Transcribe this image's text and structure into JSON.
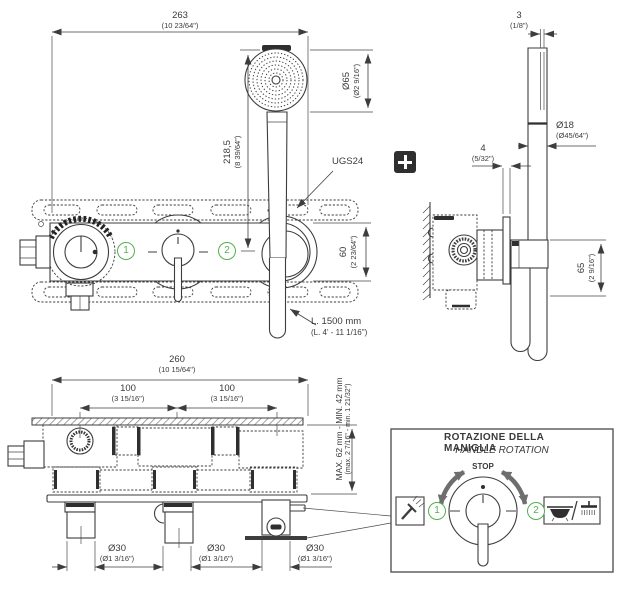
{
  "colors": {
    "line": "#3d3d3d",
    "green": "#53b14e",
    "gray": "#6e6e6e",
    "dark": "#2f2f2f"
  },
  "icons": {
    "badge": "plus-icon",
    "position1": "handshower-icon",
    "position2": "bathtub-overhead-shower-icon"
  },
  "front_view": {
    "width_mm": "263",
    "width_in": "(10 23/64\")",
    "height_mm": "218,5",
    "height_in": "(8 39/64\")",
    "head_mm": "Ø65",
    "head_in": "(Ø2 9/16\")",
    "offset_mm": "60",
    "offset_in": "(2 23/64\")",
    "bracket_code": "UGS24",
    "hose_mm": "L. 1500 mm",
    "hose_in": "(L. 4' - 11 1/16\")",
    "pos1": "1",
    "pos2": "2"
  },
  "side_view": {
    "gap_mm": "3",
    "gap_in": "(1/8\")",
    "rail_mm": "Ø18",
    "rail_in": "(Ø45/64\")",
    "plate_mm": "4",
    "plate_in": "(5/32\")",
    "height_mm": "65",
    "height_in": "(2 9/16\")"
  },
  "plan_view": {
    "width_mm": "260",
    "width_in": "(10 15/64\")",
    "pitch1_mm": "100",
    "pitch1_in": "(3 15/16\")",
    "pitch2_mm": "100",
    "pitch2_in": "(3 15/16\")",
    "depth": "MAX. 62 mm - MIN. 42 mm",
    "depth_in": "(max. 2 7/16\" - min. 1 21/32\")",
    "outlets": [
      {
        "mm": "Ø30",
        "in": "(Ø1 3/16\")"
      },
      {
        "mm": "Ø30",
        "in": "(Ø1 3/16\")"
      },
      {
        "mm": "Ø30",
        "in": "(Ø1 3/16\")"
      }
    ]
  },
  "rotation_detail": {
    "title": "ROTAZIONE DELLA MANIGLIA",
    "subtitle": "HANDLE ROTATION",
    "stop": "STOP",
    "pos1": "1",
    "pos2": "2"
  }
}
